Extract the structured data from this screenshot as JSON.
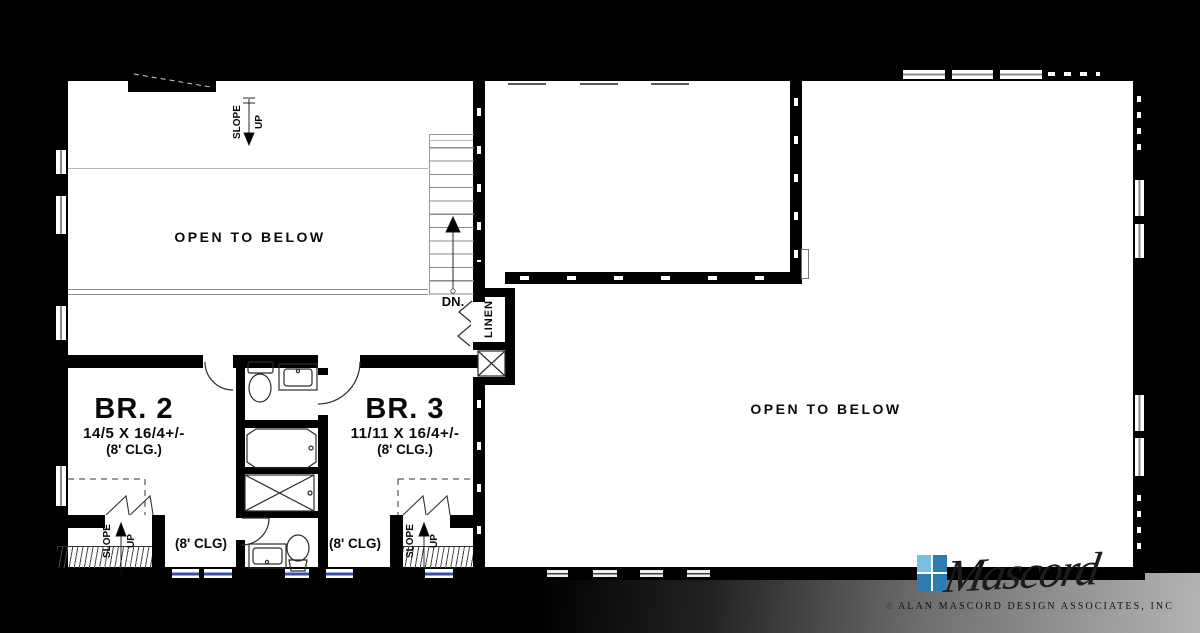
{
  "plan": {
    "wall_color": "#000000",
    "glass_color": "#3d4fa1",
    "labels": {
      "open_to_below": "OPEN TO BELOW",
      "down": "DN.",
      "linen": "LINEN",
      "slope": "SLOPE",
      "up": "UP",
      "ceiling_hall": "(8' CLG)"
    },
    "rooms": {
      "br2": {
        "name": "BR. 2",
        "dims": "14/5 X 16/4+/-",
        "ceiling": "(8' CLG.)"
      },
      "br3": {
        "name": "BR. 3",
        "dims": "11/11 X 16/4+/-",
        "ceiling": "(8' CLG.)"
      }
    }
  },
  "logo": {
    "brand": "Mascord",
    "firm": "ALAN MASCORD DESIGN ASSOCIATES, INC",
    "copyright": "©",
    "pane_light": "#79bfe3",
    "pane_dark": "#2d7cb0"
  }
}
